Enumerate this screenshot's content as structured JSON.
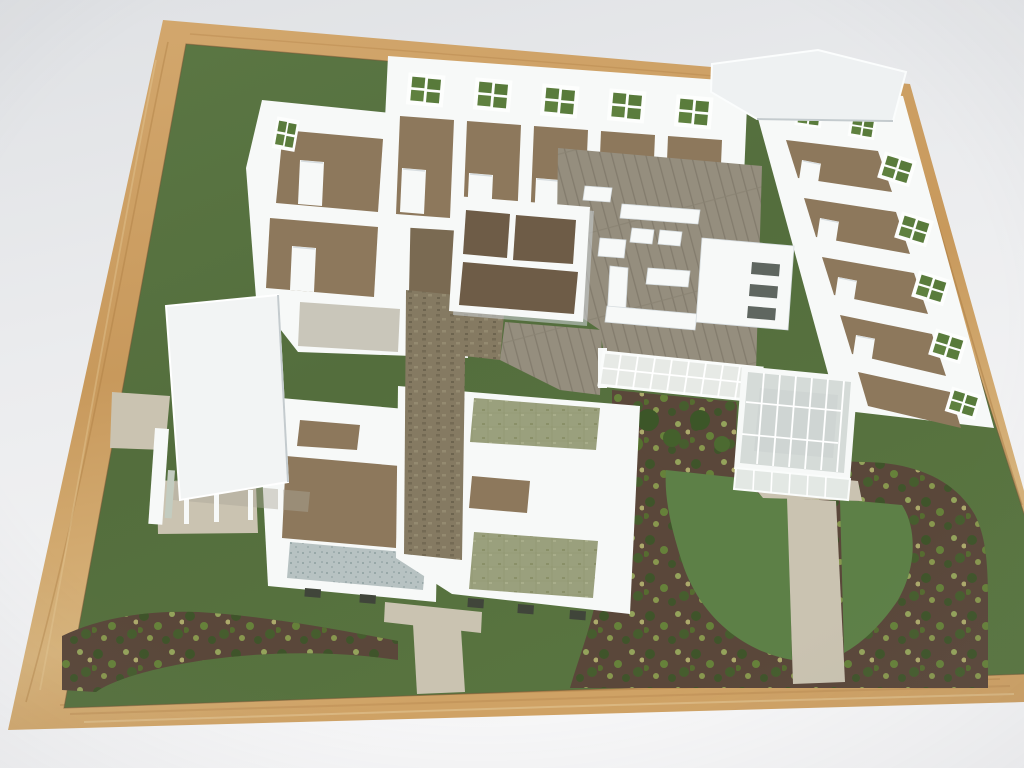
{
  "scene": {
    "type": "photograph",
    "subject": "architectural scale model of a single-story care-home style building, viewed from above at an angle",
    "elements": [
      "light oak wooden frame around the model base",
      "green landscaped baseboard",
      "white model walls forming open-top rooms",
      "top bedroom wing with green four-pane windows",
      "right bedroom wing with green four-pane windows",
      "central lounge with plank floor and white miniature furniture",
      "freestanding centre suite block",
      "glass pergola walkway and glazed conservatory sunroom",
      "flat white roof slab over the north-east corner",
      "entrance canopy on thin columns",
      "brown carpeted rooms, olive carpeted rooms, tiled hall, blue-grey terrace",
      "mulch planting beds dotted with miniature shrubs",
      "cup-shaped lawn with tan T-shaped garden path",
      "tan entry path and south walkway"
    ]
  },
  "colors": {
    "bg_edge": "#dfe1e4",
    "bg_mid": "#ebecee",
    "bg_bottom": "#f6f6f7",
    "frame_light": "#e5c492",
    "frame_mid": "#c89a5f",
    "frame_dark": "#a5763f",
    "board_green": "#57713f",
    "board_green_deep": "#4d6537",
    "lawn_green": "#5d8047",
    "mulch": "#5a473a",
    "mulch_dark": "#483a2e",
    "shrub_dark": "#3c5628",
    "shrub_mid": "#67883a",
    "shrub_light": "#9aad5e",
    "shrub_yellow": "#c2c377",
    "path_tan": "#cac3b1",
    "wall": "#f7f9f8",
    "wall_shade": "#d7dde0",
    "wall_dark": "#c4cbce",
    "roof_white": "#eef1f2",
    "carpet_brown": "#8d785c",
    "carpet_dark": "#7a6a52",
    "suite_floor": "#6e5c47",
    "carpet_olive": "#9aa07d",
    "tile_light": "#c9c6ba",
    "plank": "#958e7e",
    "plank_line": "#837c6d",
    "terrace_blue": "#b7c2c2",
    "glass": "#e7eae6",
    "glass_deep": "#d5dbd8",
    "sunroom_floor": "#cfd5d3",
    "window_green": "#5a7c3c",
    "slit_dark": "#40453a"
  }
}
